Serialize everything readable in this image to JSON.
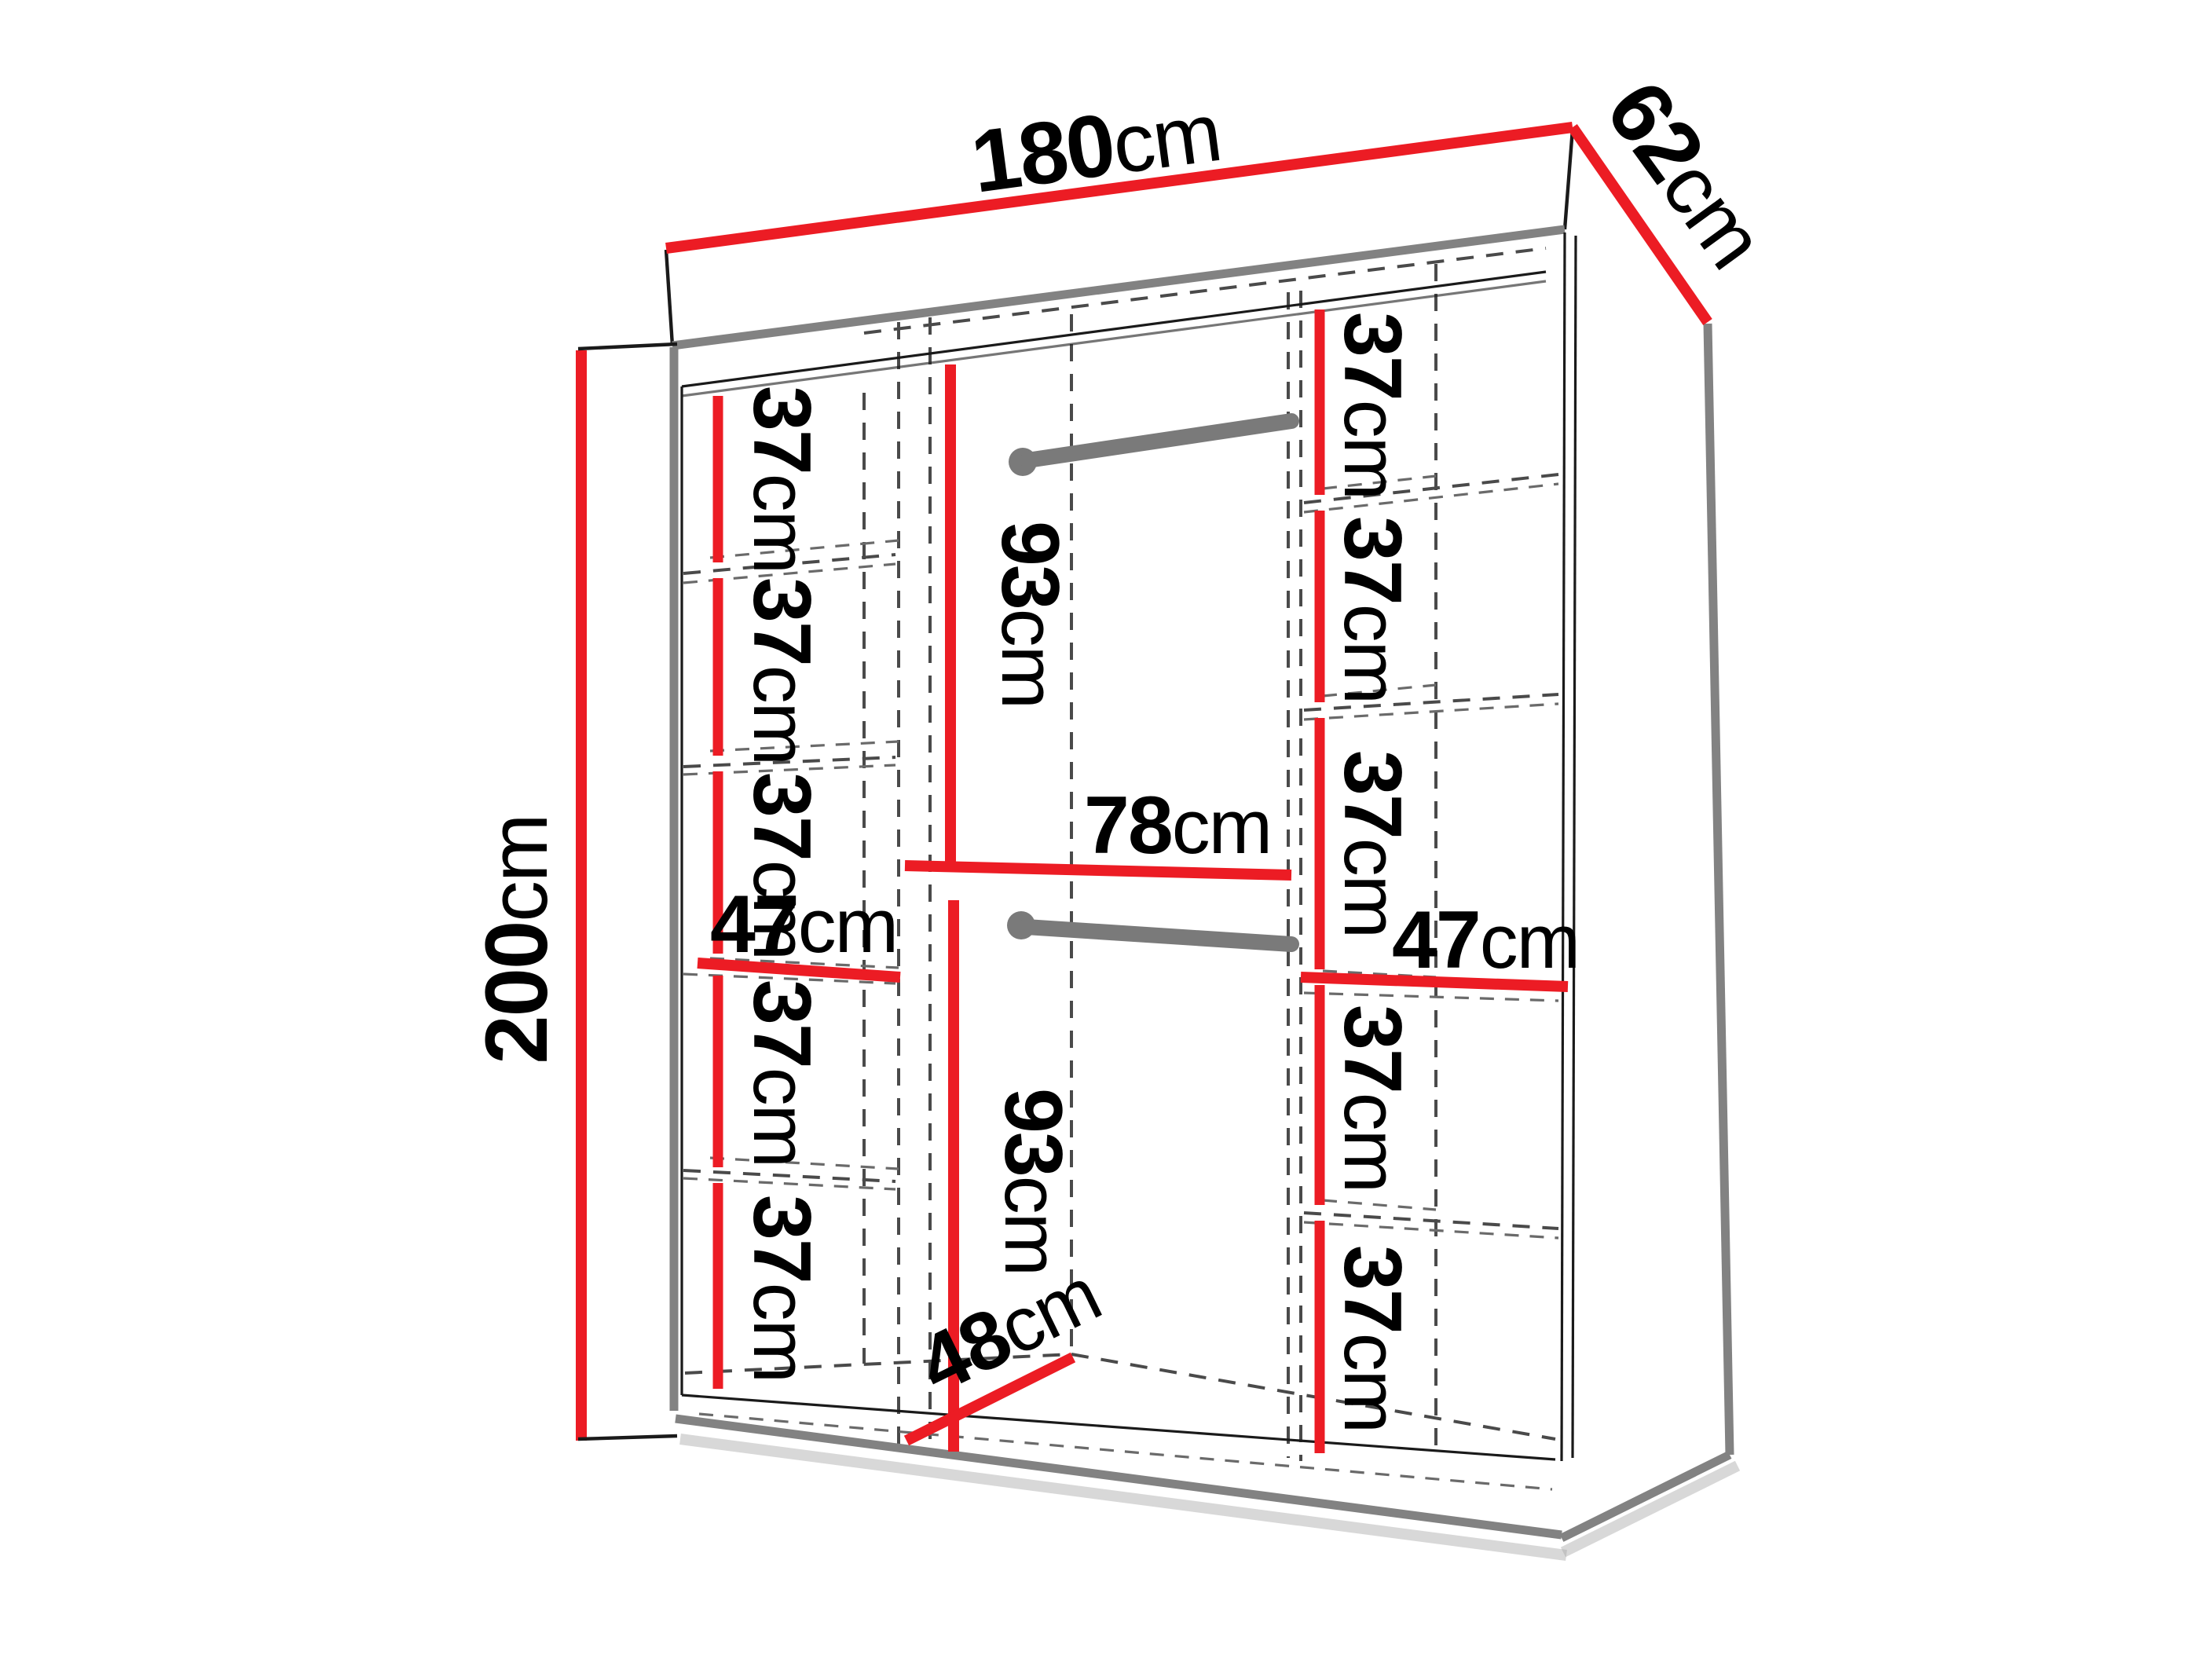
{
  "title": "Wardrobe dimension diagram 180x62x200",
  "colors": {
    "dimension_red": "#ec1c24",
    "structure_gray": "#828282",
    "rod_gray": "#7a7a7a",
    "dashed_gray": "#4a4a4a",
    "text": "#000000",
    "background": "#ffffff"
  },
  "overall": {
    "width": {
      "value": "180",
      "unit": "cm"
    },
    "depth": {
      "value": "62",
      "unit": "cm"
    },
    "height": {
      "value": "200",
      "unit": "cm"
    }
  },
  "left_column": {
    "width": {
      "value": "47",
      "unit": "cm"
    },
    "shelves": [
      {
        "value": "37",
        "unit": "cm"
      },
      {
        "value": "37",
        "unit": "cm"
      },
      {
        "value": "37",
        "unit": "cm"
      },
      {
        "value": "37",
        "unit": "cm"
      },
      {
        "value": "37",
        "unit": "cm"
      }
    ]
  },
  "right_column": {
    "width": {
      "value": "47",
      "unit": "cm"
    },
    "shelves": [
      {
        "value": "37",
        "unit": "cm"
      },
      {
        "value": "37",
        "unit": "cm"
      },
      {
        "value": "37",
        "unit": "cm"
      },
      {
        "value": "37",
        "unit": "cm"
      },
      {
        "value": "37",
        "unit": "cm"
      }
    ]
  },
  "middle_section": {
    "width": {
      "value": "78",
      "unit": "cm"
    },
    "floor_depth": {
      "value": "48",
      "unit": "cm"
    },
    "upper_hanging": {
      "value": "93",
      "unit": "cm"
    },
    "lower_hanging": {
      "value": "93",
      "unit": "cm"
    },
    "rod_count": 2
  }
}
